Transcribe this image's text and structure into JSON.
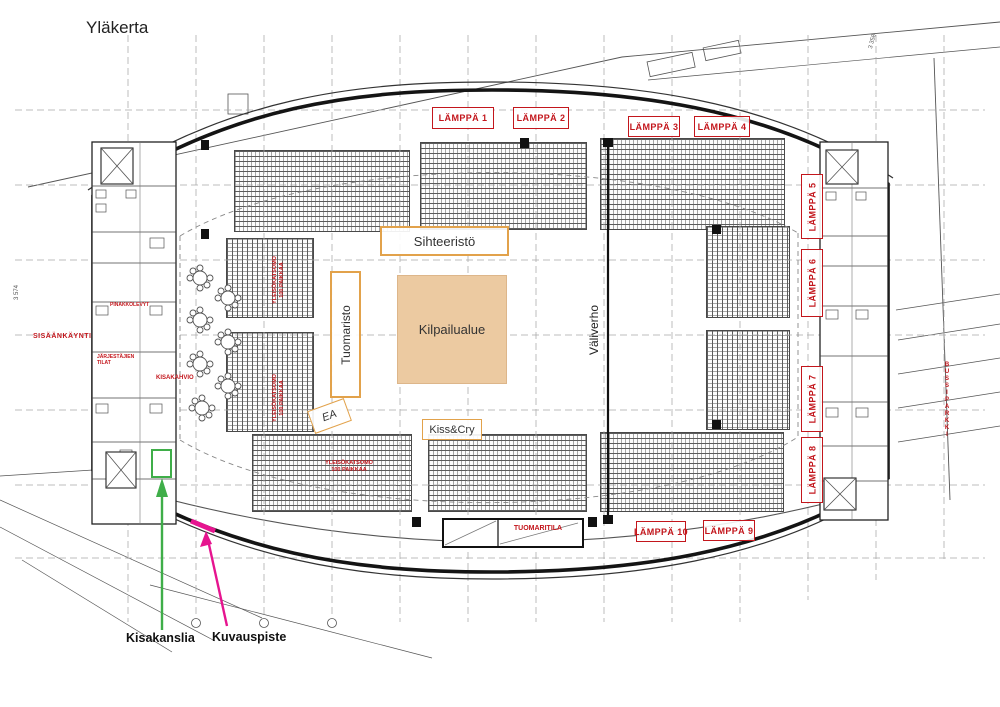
{
  "title": "Yläkerta",
  "colors": {
    "red_label": "#c3161c",
    "orange_zone": "#e2a24b",
    "competition_fill": "#eccaa1",
    "green_annotation": "#3fae49",
    "magenta_annotation": "#e6148f",
    "drawing_line": "#161616"
  },
  "lamppa": {
    "items": [
      {
        "label": "LÄMPPÄ 1"
      },
      {
        "label": "LÄMPPÄ 2"
      },
      {
        "label": "LÄMPPÄ 3"
      },
      {
        "label": "LÄMPPÄ 4"
      },
      {
        "label": "LÄMPPÄ 5"
      },
      {
        "label": "LÄMPPÄ 6"
      },
      {
        "label": "LÄMPPÄ 7"
      },
      {
        "label": "LÄMPPÄ 8"
      },
      {
        "label": "LÄMPPÄ 9"
      },
      {
        "label": "LÄMPPÄ 10"
      }
    ]
  },
  "zones": {
    "sihteeristo": "Sihteeristö",
    "tuomaristo": "Tuomaristo",
    "kilpailualue": "Kilpailualue",
    "valiverho": "Väliverho",
    "kiss_cry": "Kiss&Cry",
    "ea": "EA"
  },
  "red_labels": {
    "sisaankaynti": "SISÄÄNKÄYNTI",
    "pinakkolevyt": "PINAKKOLEVYT",
    "tilat_line1": "JÄRJESTÄJIEN",
    "tilat_line2": "TILAT",
    "kisakahvio": "KISAKAHVIO",
    "tuomaritila": "TUOMARITILA",
    "bussiparkki": "BUSSIPARKKI",
    "katsomo_line1": "YLEISÖKATSOMO",
    "katsomo_line2": "100 PAIKKAA"
  },
  "annotations": {
    "kisakanslia": "Kisakanslia",
    "kuvauspiste": "Kuvauspiste"
  },
  "dimensions": {
    "left": "3 574",
    "top_right": "3 358"
  }
}
